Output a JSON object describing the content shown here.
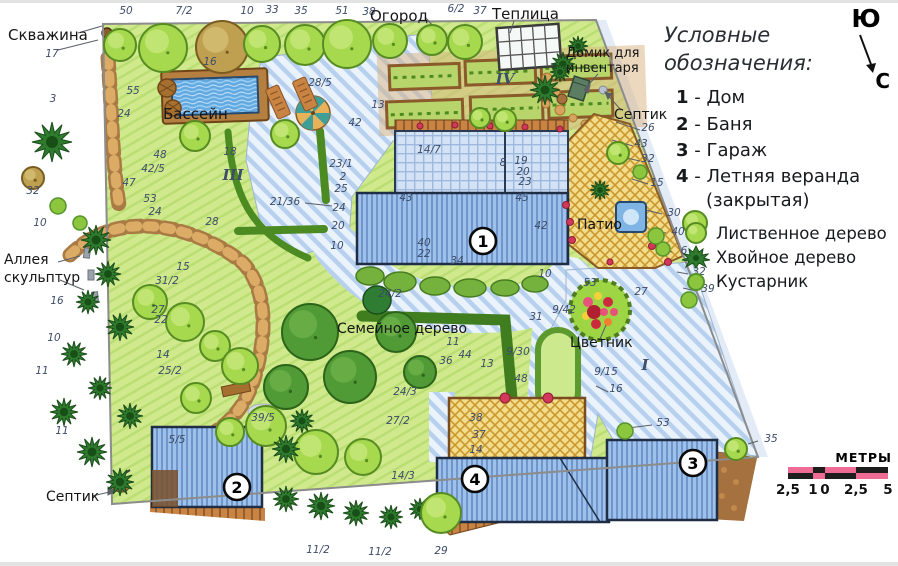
{
  "legend": {
    "title": "Условные обозначения:",
    "separator": " - ",
    "items": [
      {
        "num": "1",
        "label": "Дом"
      },
      {
        "num": "2",
        "label": "Баня"
      },
      {
        "num": "3",
        "label": "Гараж"
      },
      {
        "num": "4",
        "label": "Летняя веранда",
        "label_cont": "(закрытая)"
      }
    ],
    "tree_symbols": [
      {
        "icon": "deciduous-tree-icon",
        "label": "Лиственное дерево"
      },
      {
        "icon": "conifer-tree-icon",
        "label": "Хвойное дерево"
      },
      {
        "icon": "shrub-icon",
        "label": "Кустарник"
      }
    ]
  },
  "compass": {
    "south_label": "Ю",
    "north_label": "С"
  },
  "scalebar": {
    "title": "МЕТРЫ",
    "tick_labels": [
      "2,5",
      "1",
      "0",
      "2,5",
      "5"
    ]
  },
  "plan": {
    "labels": [
      {
        "t": "Скважина",
        "x": 8,
        "y": 40,
        "s": 15
      },
      {
        "t": "Бассейн",
        "x": 163,
        "y": 119,
        "s": 15
      },
      {
        "t": "Огород",
        "x": 370,
        "y": 21,
        "s": 15
      },
      {
        "t": "Теплица",
        "x": 492,
        "y": 19,
        "s": 15
      },
      {
        "t": "Домик для",
        "x": 566,
        "y": 57,
        "s": 13
      },
      {
        "t": "инвентаря",
        "x": 566,
        "y": 72,
        "s": 13
      },
      {
        "t": "Септик",
        "x": 614,
        "y": 119,
        "s": 14
      },
      {
        "t": "Септик",
        "x": 46,
        "y": 501,
        "s": 14
      },
      {
        "t": "Аллея",
        "x": 4,
        "y": 264,
        "s": 14
      },
      {
        "t": "скульптур",
        "x": 4,
        "y": 282,
        "s": 14
      },
      {
        "t": "Патио",
        "x": 577,
        "y": 229,
        "s": 14
      },
      {
        "t": "Семейное дерево",
        "x": 337,
        "y": 333,
        "s": 14
      },
      {
        "t": "Цветник",
        "x": 570,
        "y": 347,
        "s": 14
      }
    ],
    "zone_numerals": [
      {
        "t": "III",
        "x": 233,
        "y": 180
      },
      {
        "t": "I",
        "x": 645,
        "y": 370
      },
      {
        "t": "IV",
        "x": 505,
        "y": 84
      }
    ],
    "building_badges": [
      {
        "num": "1",
        "x": 483,
        "y": 241
      },
      {
        "num": "2",
        "x": 237,
        "y": 487
      },
      {
        "num": "3",
        "x": 693,
        "y": 463
      },
      {
        "num": "4",
        "x": 475,
        "y": 479
      }
    ],
    "measurements": [
      [
        "50",
        126,
        14
      ],
      [
        "7/2",
        184,
        14
      ],
      [
        "10",
        247,
        14
      ],
      [
        "33",
        272,
        13
      ],
      [
        "35",
        301,
        14
      ],
      [
        "51",
        342,
        14
      ],
      [
        "38",
        369,
        15
      ],
      [
        "6/2",
        456,
        12
      ],
      [
        "37",
        480,
        14
      ],
      [
        "17",
        52,
        57
      ],
      [
        "3",
        53,
        102
      ],
      [
        "32",
        33,
        194
      ],
      [
        "10",
        40,
        226
      ],
      [
        "16",
        57,
        304
      ],
      [
        "10",
        54,
        341
      ],
      [
        "11",
        42,
        374
      ],
      [
        "11",
        62,
        434
      ],
      [
        "16",
        210,
        65
      ],
      [
        "55",
        133,
        94
      ],
      [
        "24",
        124,
        117
      ],
      [
        "48",
        160,
        158
      ],
      [
        "42/5",
        153,
        172
      ],
      [
        "47",
        129,
        186
      ],
      [
        "18",
        230,
        155
      ],
      [
        "53",
        150,
        202
      ],
      [
        "24",
        155,
        215
      ],
      [
        "28",
        212,
        225
      ],
      [
        "28/5",
        320,
        86
      ],
      [
        "13",
        378,
        108
      ],
      [
        "42",
        355,
        126
      ],
      [
        "14/7",
        429,
        153
      ],
      [
        "8",
        503,
        166
      ],
      [
        "19",
        521,
        164
      ],
      [
        "20",
        523,
        175
      ],
      [
        "23",
        525,
        185
      ],
      [
        "45",
        522,
        201
      ],
      [
        "42",
        541,
        229
      ],
      [
        "43",
        406,
        201
      ],
      [
        "40",
        424,
        246
      ],
      [
        "22",
        424,
        257
      ],
      [
        "34",
        457,
        264
      ],
      [
        "10",
        545,
        277
      ],
      [
        "24/2",
        390,
        297
      ],
      [
        "23/1",
        341,
        167
      ],
      [
        "2",
        343,
        180
      ],
      [
        "25",
        341,
        192
      ],
      [
        "24",
        339,
        211
      ],
      [
        "20",
        338,
        229
      ],
      [
        "10",
        337,
        249
      ],
      [
        "21/36",
        285,
        205
      ],
      [
        "26",
        648,
        131
      ],
      [
        "43",
        641,
        147
      ],
      [
        "32",
        648,
        162
      ],
      [
        "15",
        657,
        186
      ],
      [
        "30",
        674,
        216
      ],
      [
        "40",
        678,
        235
      ],
      [
        "6",
        684,
        254
      ],
      [
        "32",
        699,
        275
      ],
      [
        "39",
        708,
        292
      ],
      [
        "35",
        771,
        442
      ],
      [
        "15",
        183,
        270
      ],
      [
        "31/2",
        167,
        284
      ],
      [
        "27",
        158,
        313
      ],
      [
        "22",
        161,
        323
      ],
      [
        "14",
        163,
        358
      ],
      [
        "25/2",
        170,
        374
      ],
      [
        "31",
        536,
        320
      ],
      [
        "9/42",
        564,
        313
      ],
      [
        "53",
        590,
        286
      ],
      [
        "27",
        641,
        295
      ],
      [
        "11",
        453,
        345
      ],
      [
        "44",
        465,
        358
      ],
      [
        "36",
        446,
        364
      ],
      [
        "13",
        487,
        367
      ],
      [
        "24/3",
        405,
        395
      ],
      [
        "27/2",
        398,
        424
      ],
      [
        "14/3",
        403,
        479
      ],
      [
        "9/30",
        518,
        355
      ],
      [
        "48",
        521,
        382
      ],
      [
        "9/15",
        606,
        375
      ],
      [
        "38",
        476,
        421
      ],
      [
        "37",
        479,
        438
      ],
      [
        "14",
        476,
        453
      ],
      [
        "16",
        616,
        392
      ],
      [
        "53",
        663,
        426
      ],
      [
        "5/5",
        177,
        443
      ],
      [
        "39/5",
        263,
        421
      ],
      [
        "11/2",
        318,
        553
      ],
      [
        "11/2",
        380,
        555
      ],
      [
        "29",
        441,
        554
      ]
    ],
    "tree_types": {
      "d": "deciduous",
      "D": "dark-deciduous",
      "c": "conifer",
      "s": "shrub",
      "b": "tan-tree"
    },
    "trees": [
      [
        "d",
        120,
        45,
        16
      ],
      [
        "d",
        163,
        48,
        24
      ],
      [
        "b",
        222,
        47,
        26
      ],
      [
        "d",
        262,
        44,
        18
      ],
      [
        "d",
        305,
        45,
        20
      ],
      [
        "d",
        347,
        44,
        24
      ],
      [
        "d",
        390,
        41,
        17
      ],
      [
        "d",
        432,
        40,
        15
      ],
      [
        "d",
        465,
        42,
        17
      ],
      [
        "c",
        545,
        90,
        15
      ],
      [
        "c",
        563,
        64,
        12
      ],
      [
        "c",
        578,
        46,
        10
      ],
      [
        "c",
        560,
        72,
        10
      ],
      [
        "d",
        195,
        136,
        15
      ],
      [
        "d",
        285,
        134,
        14
      ],
      [
        "d",
        618,
        153,
        11
      ],
      [
        "s",
        640,
        172,
        7
      ],
      [
        "c",
        52,
        142,
        20
      ],
      [
        "b",
        33,
        178,
        11
      ],
      [
        "s",
        58,
        206,
        8
      ],
      [
        "s",
        80,
        223,
        7
      ],
      [
        "c",
        96,
        240,
        15
      ],
      [
        "c",
        108,
        274,
        13
      ],
      [
        "c",
        88,
        302,
        12
      ],
      [
        "c",
        120,
        327,
        14
      ],
      [
        "c",
        74,
        354,
        13
      ],
      [
        "c",
        100,
        388,
        12
      ],
      [
        "c",
        64,
        412,
        14
      ],
      [
        "c",
        130,
        416,
        13
      ],
      [
        "c",
        92,
        452,
        15
      ],
      [
        "c",
        120,
        482,
        14
      ],
      [
        "d",
        150,
        302,
        17
      ],
      [
        "d",
        185,
        322,
        19
      ],
      [
        "d",
        215,
        346,
        15
      ],
      [
        "D",
        310,
        332,
        28
      ],
      [
        "D",
        350,
        377,
        26
      ],
      [
        "D",
        286,
        387,
        22
      ],
      [
        "D",
        396,
        332,
        20
      ],
      [
        "D",
        420,
        372,
        16
      ],
      [
        "d",
        240,
        366,
        18
      ],
      [
        "d",
        266,
        426,
        20
      ],
      [
        "d",
        316,
        452,
        22
      ],
      [
        "d",
        363,
        457,
        18
      ],
      [
        "d",
        230,
        432,
        14
      ],
      [
        "c",
        286,
        499,
        13
      ],
      [
        "c",
        321,
        506,
        14
      ],
      [
        "c",
        356,
        513,
        13
      ],
      [
        "c",
        391,
        517,
        12
      ],
      [
        "c",
        420,
        509,
        11
      ],
      [
        "d",
        441,
        513,
        20
      ],
      [
        "d",
        196,
        398,
        15
      ],
      [
        "c",
        286,
        449,
        14
      ],
      [
        "c",
        302,
        421,
        12
      ],
      [
        "d",
        736,
        449,
        11
      ],
      [
        "s",
        625,
        431,
        8
      ],
      [
        "d",
        695,
        223,
        12
      ],
      [
        "s",
        656,
        236,
        8
      ],
      [
        "s",
        663,
        249,
        7
      ],
      [
        "s",
        689,
        300,
        8
      ],
      [
        "c",
        600,
        190,
        10
      ],
      [
        "d",
        505,
        120,
        11
      ],
      [
        "d",
        480,
        118,
        10
      ]
    ],
    "colors": {
      "lawn": "#cfe98c",
      "paving_stripe": "#b6d0ee",
      "building_fill": "#9dc1e8",
      "deck_yellow": "#f3dc8c",
      "pool_water": "#62a9e2",
      "measurement_text": "#3d4c68",
      "scale_pink": "#ee6b96",
      "scale_black": "#1d1d1d"
    }
  }
}
